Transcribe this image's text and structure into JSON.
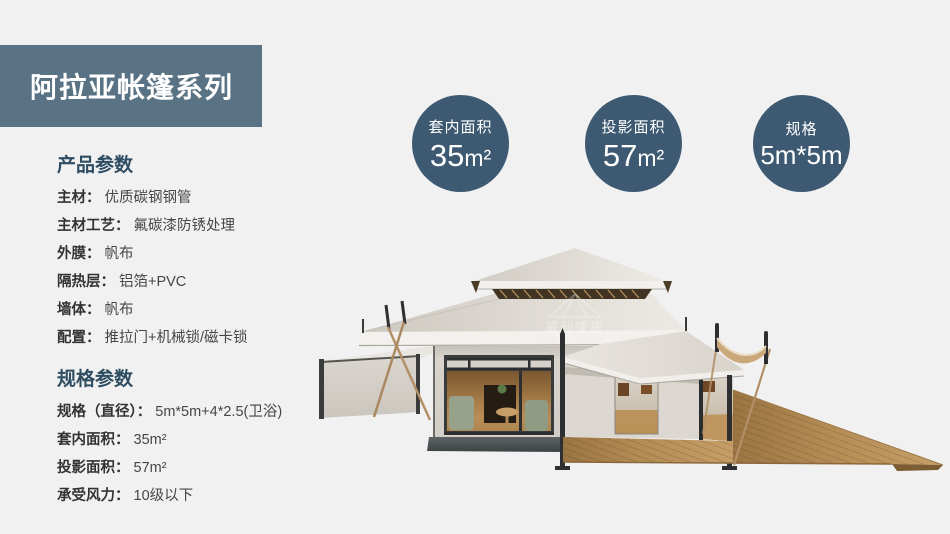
{
  "page": {
    "background": "#f1f1f2"
  },
  "banner": {
    "title": "阿拉亚帐篷系列",
    "bg_color": "#5a7384",
    "text_color": "#ffffff"
  },
  "badge_color": "#3d5a72",
  "badges": [
    {
      "label": "套内面积",
      "value": "35",
      "unit": "m²"
    },
    {
      "label": "投影面积",
      "value": "57",
      "unit": "m²"
    },
    {
      "label": "规格",
      "value": "5m*5m",
      "unit": ""
    }
  ],
  "sections": [
    {
      "heading": "产品参数",
      "rows": [
        {
          "label": "主材：",
          "value": "优质碳钢钢管"
        },
        {
          "label": "主材工艺：",
          "value": "氟碳漆防锈处理"
        },
        {
          "label": "外膜：",
          "value": "帆布"
        },
        {
          "label": "隔热层：",
          "value": "铝箔+PVC"
        },
        {
          "label": "墙体：",
          "value": "帆布"
        },
        {
          "label": "配置：",
          "value": "推拉门+机械锁/磁卡锁"
        }
      ]
    },
    {
      "heading": "规格参数",
      "rows": [
        {
          "label": "规格（直径）：",
          "value": "5m*5m+4*2.5(卫浴)"
        },
        {
          "label": "套内面积：",
          "value": "35m²"
        },
        {
          "label": "投影面积：",
          "value": "57m²"
        },
        {
          "label": "承受风力：",
          "value": "10级以下"
        }
      ]
    }
  ],
  "illustration": {
    "watermark_cn": "威利篷房",
    "watermark_en": "WELL TENT"
  }
}
